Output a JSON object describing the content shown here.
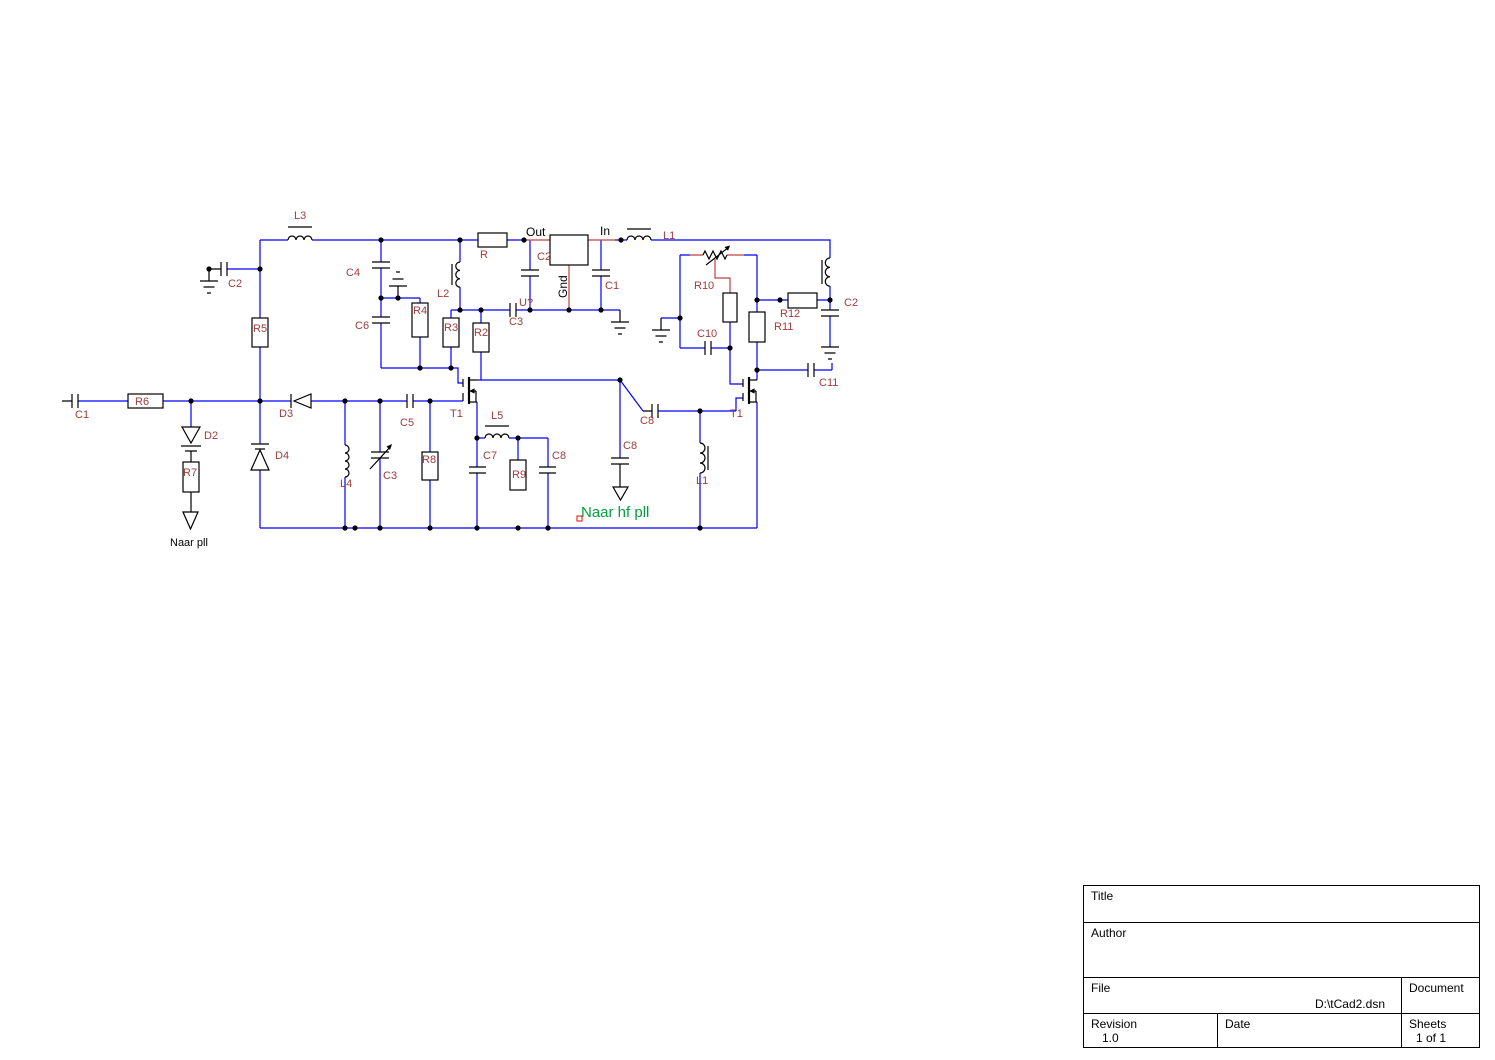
{
  "schematic": {
    "colors": {
      "wire": "#0000ff",
      "component": "#000000",
      "reference": "#a03c3c",
      "pin_wire": "#bf4040",
      "net_green": "#00a040",
      "selection": "#ff0000"
    },
    "labels": {
      "l3": "L3",
      "c2_left": "C2",
      "r5": "R5",
      "c4": "C4",
      "c6": "C6",
      "r4": "R4",
      "l2": "L2",
      "r3": "R3",
      "r2": "R2",
      "r": "R",
      "c2_reg": "C2",
      "c1_reg": "C1",
      "u_ref": "U?",
      "c3_reg": "C3",
      "l1_top": "L1",
      "r10": "R10",
      "c10": "C10",
      "r11": "R11",
      "r12": "R12",
      "c2_right": "C2",
      "c11": "C11",
      "c1_in": "C1",
      "r6": "R6",
      "d2": "D2",
      "r7": "R7",
      "d3": "D3",
      "d4": "D4",
      "l4": "L4",
      "c3_var": "C3",
      "c5": "C5",
      "r8": "R8",
      "t1_left": "T1",
      "l5": "L5",
      "c7": "C7",
      "r9": "R9",
      "c8_1": "C8",
      "c8_2": "C8",
      "c8_3": "C8",
      "l1_bot": "L1",
      "t1_right": "T1"
    },
    "nets": {
      "out": "Out",
      "in": "In",
      "gnd": "Gnd",
      "naar_pll": "Naar pll",
      "naar_hf_pll": "Naar hf pll"
    }
  },
  "title_block": {
    "title_label": "Title",
    "author_label": "Author",
    "file_label": "File",
    "file_value": "D:\\tCad2.dsn",
    "document_label": "Document",
    "revision_label": "Revision",
    "revision_value": "1.0",
    "date_label": "Date",
    "sheets_label": "Sheets",
    "sheets_value": "1 of 1"
  }
}
